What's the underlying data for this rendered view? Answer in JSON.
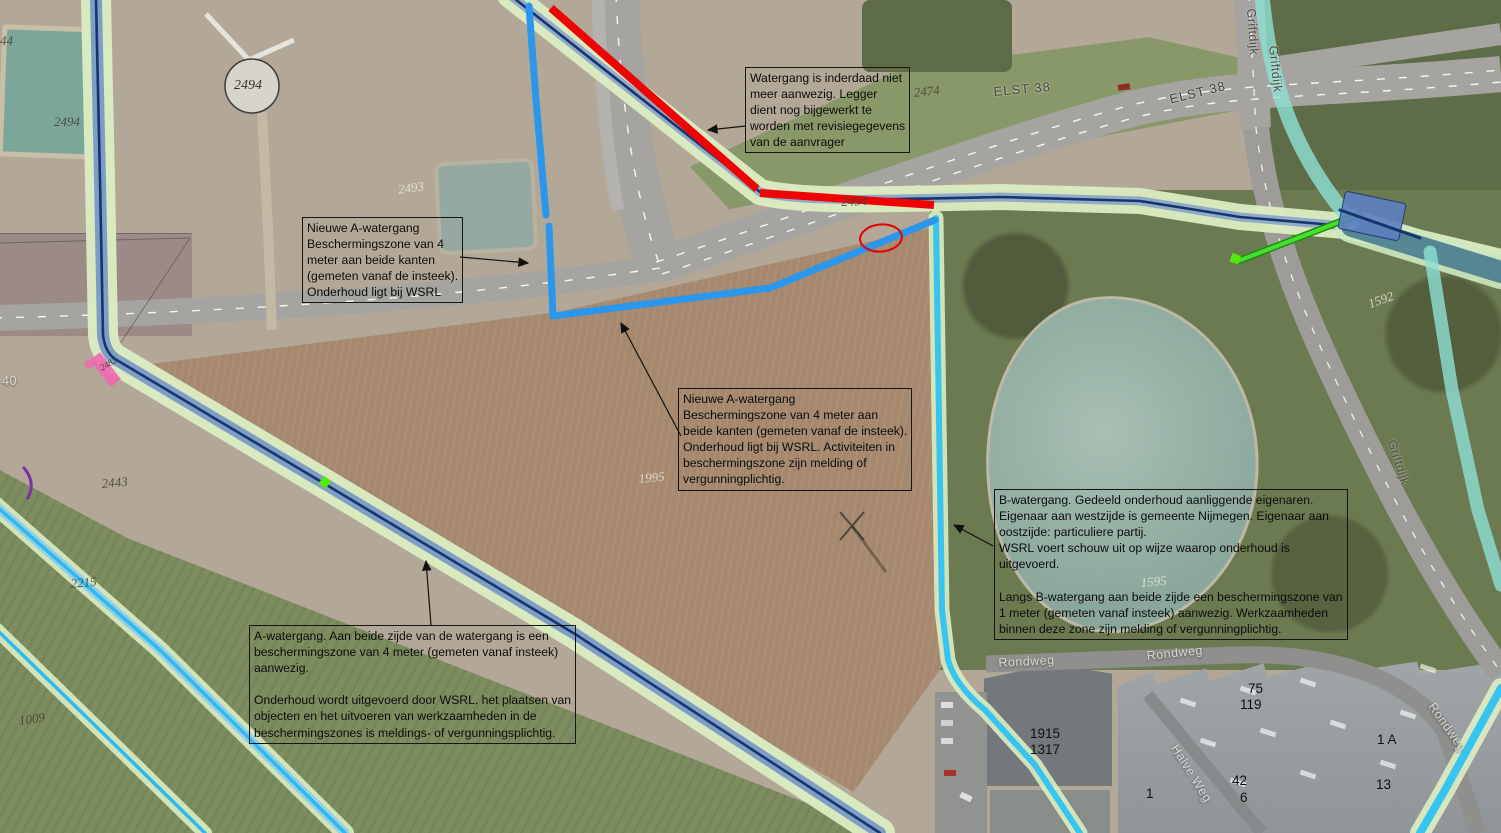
{
  "annotations": [
    {
      "id": "watergang-verwijderd",
      "x": 745,
      "y": 67,
      "text": "Watergang is inderdaad niet\nmeer aanwezig. Legger\ndient nog bijgewerkt te\nworden met revisiegegevens\nvan de aanvrager"
    },
    {
      "id": "nieuwe-a-watergang-klein",
      "x": 302,
      "y": 217,
      "text": "Nieuwe A-watergang\nBeschermingszone van 4\nmeter aan beide kanten\n(gemeten vanaf de insteek).\nOnderhoud ligt bij WSRL"
    },
    {
      "id": "nieuwe-a-watergang-groot",
      "x": 678,
      "y": 388,
      "text": "Nieuwe A-watergang\nBeschermingszone van 4 meter aan\nbeide kanten (gemeten vanaf de insteek).\nOnderhoud ligt bij WSRL. Activiteiten in\nbeschermingszone zijn melding of\nvergunningplichtig."
    },
    {
      "id": "b-watergang",
      "x": 994,
      "y": 489,
      "text": "B-watergang. Gedeeld onderhoud aanliggende eigenaren.\nEigenaar aan westzijde is gemeente Nijmegen. Eigenaar aan\noostzijde: particuliere partij.\nWSRL voert schouw uit op wijze waarop onderhoud is\nuitgevoerd.\n\nLangs B-watergang aan beide zijde een beschermingszone van\n1 meter (gemeten vanaf insteek) aanwezig. Werkzaamheden\nbinnen deze zone zijn melding of vergunningplichtig."
    },
    {
      "id": "a-watergang",
      "x": 249,
      "y": 625,
      "text": "A-watergang. Aan beide zijde van de watergang is een\nbeschermingszone van 4 meter (gemeten vanaf insteek)\naanwezig.\n\nOnderhoud wordt uitgevoerd door WSRL. het plaatsen van\nobjecten en het uitvoeren van werkzaamheden in de\nbeschermingszones is meldings- of vergunningsplichtig."
    }
  ],
  "map_labels": [
    {
      "t": "44",
      "x": 0,
      "y": 33,
      "r": 0,
      "s": "serifD"
    },
    {
      "t": "2494",
      "x": 54,
      "y": 114,
      "r": 0,
      "s": "serifD"
    },
    {
      "t": "2493",
      "x": 397,
      "y": 182,
      "r": -8,
      "s": "serifL"
    },
    {
      "t": "2474",
      "x": 913,
      "y": 85,
      "r": -6,
      "s": "serifD"
    },
    {
      "t": "ELST 38",
      "x": 993,
      "y": 84,
      "r": -5,
      "s": "road2"
    },
    {
      "t": "ELST 38",
      "x": 1168,
      "y": 92,
      "r": -14,
      "s": "road2"
    },
    {
      "t": "2494",
      "x": 841,
      "y": 194,
      "r": -2,
      "s": "serifD"
    },
    {
      "t": "1592",
      "x": 1366,
      "y": 297,
      "r": -20,
      "s": "serifL"
    },
    {
      "t": "Griftdijk",
      "x": 1258,
      "y": 8,
      "r": 86,
      "s": "roadD"
    },
    {
      "t": "Griftdijk",
      "x": 1280,
      "y": 45,
      "r": 84,
      "s": "roadD"
    },
    {
      "t": "Griftdijk",
      "x": 1398,
      "y": 438,
      "r": 72,
      "s": "roadD"
    },
    {
      "t": "Rondweg",
      "x": 998,
      "y": 656,
      "r": -3,
      "s": "roadL"
    },
    {
      "t": "Rondweg",
      "x": 1146,
      "y": 649,
      "r": -6,
      "s": "roadL"
    },
    {
      "t": "Rondweg",
      "x": 1437,
      "y": 700,
      "r": 55,
      "s": "roadL"
    },
    {
      "t": "Halve Weg",
      "x": 1180,
      "y": 742,
      "r": 58,
      "s": "roadL"
    },
    {
      "t": "75",
      "x": 1248,
      "y": 681,
      "r": 0,
      "s": "addr"
    },
    {
      "t": "119",
      "x": 1240,
      "y": 697,
      "r": 0,
      "s": "addr"
    },
    {
      "t": "1915",
      "x": 1030,
      "y": 726,
      "r": 0,
      "s": "addr"
    },
    {
      "t": "1317",
      "x": 1030,
      "y": 742,
      "r": 0,
      "s": "addr"
    },
    {
      "t": "42",
      "x": 1232,
      "y": 773,
      "r": 0,
      "s": "addr"
    },
    {
      "t": "6",
      "x": 1240,
      "y": 790,
      "r": 0,
      "s": "addr"
    },
    {
      "t": "13",
      "x": 1376,
      "y": 777,
      "r": 0,
      "s": "addr"
    },
    {
      "t": "1 A",
      "x": 1377,
      "y": 732,
      "r": 0,
      "s": "addr"
    },
    {
      "t": "1",
      "x": 1146,
      "y": 786,
      "r": 0,
      "s": "addr"
    },
    {
      "t": "40",
      "x": 2,
      "y": 374,
      "r": 0,
      "s": "roadL"
    },
    {
      "t": "2443",
      "x": 101,
      "y": 476,
      "r": -5,
      "s": "serifD"
    },
    {
      "t": "2215",
      "x": 70,
      "y": 576,
      "r": -5,
      "s": "serifD"
    },
    {
      "t": "1009",
      "x": 18,
      "y": 713,
      "r": -8,
      "s": "serifD"
    },
    {
      "t": "2482",
      "x": 98,
      "y": 364,
      "r": -30,
      "s": "serifT"
    },
    {
      "t": "1995",
      "x": 638,
      "y": 471,
      "r": -5,
      "s": "serifL"
    },
    {
      "t": "1595",
      "x": 1140,
      "y": 575,
      "r": -5,
      "s": "serifL"
    },
    {
      "t": "2494",
      "x": 234,
      "y": 78,
      "r": 0,
      "s": "serifW"
    }
  ],
  "overlay_colors": {
    "legger_band_green": "#dcedc2",
    "legger_line_navy": "#16356e",
    "legger_band_blue": "#6e90c6",
    "new_a_watergang_blue": "#2a97ec",
    "b_watergang_cyan": "#38c4f0",
    "removed_watergang_red": "#ee0404",
    "culvert_pink": "#ee68b2",
    "connector_green": "#44e02c",
    "turquoise_band": "#8fe0d4",
    "highlight_oval_red": "#e60000"
  }
}
